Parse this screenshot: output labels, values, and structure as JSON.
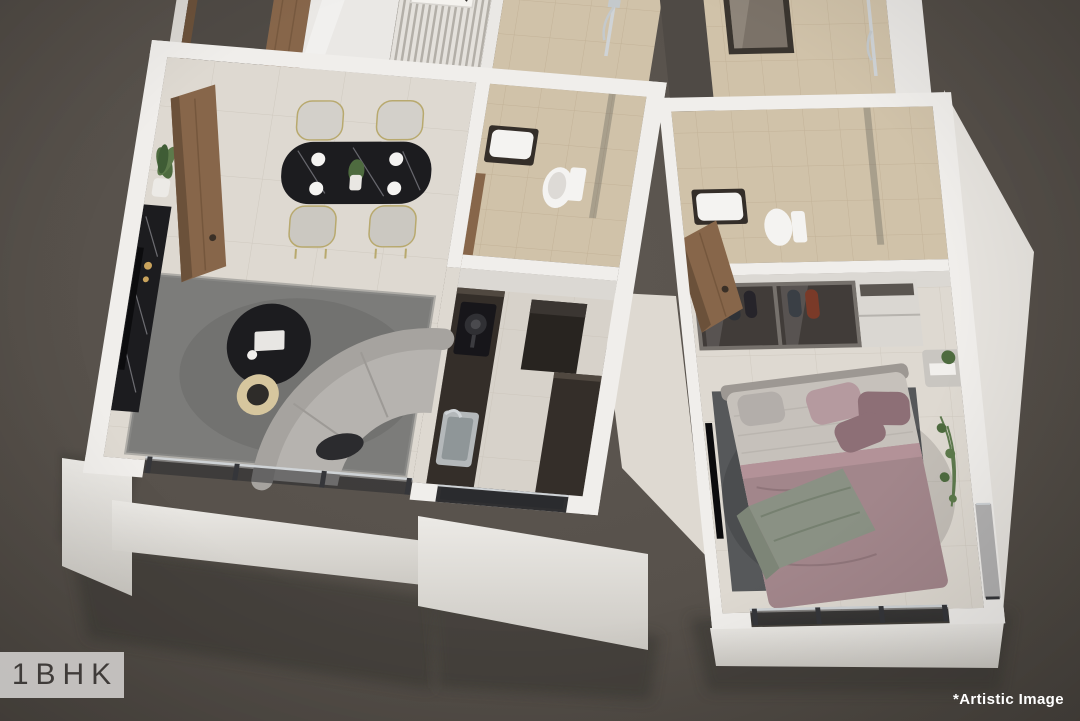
{
  "image_type": "3d-isometric-1bhk-floor-plan-render",
  "overlay": {
    "plan_label": "1BHK",
    "disclaimer": "*Artistic Image"
  },
  "palette": {
    "background": "#57514b",
    "background_edge": "#4a453f",
    "wall_white": "#f0eeeb",
    "wall_shade": "#dbd8d3",
    "interior_dark_wall": "#4f4a45",
    "floor_cream": "#ded9d1",
    "floor_kitchen": "#d7d2ca",
    "tile_beige": "#d0c2a9",
    "wood": "#87664a",
    "wood_dark": "#6b513a",
    "counter_dark": "#342e29",
    "marble_black": "#1c1c1f",
    "sofa_gray": "#b6b3af",
    "rug_living": "#7c7c7a",
    "rug_bedroom": "#56585a",
    "bed_mauve": "#a2868b",
    "pillow_mauve": "#8d6f76",
    "throw_green": "#8a9184",
    "mattress_light": "#c6c1bb",
    "glass_tint": "rgba(35,38,42,0.5)",
    "gold": "#c9a35c",
    "plant_green": "#4e6b3f",
    "chrome": "#cfd3d6",
    "artwork_orange": "#c9722a",
    "label_box_bg": "#c9c7c4",
    "label_text": "#3f3c39",
    "disclaimer_text": "#ffffff"
  }
}
